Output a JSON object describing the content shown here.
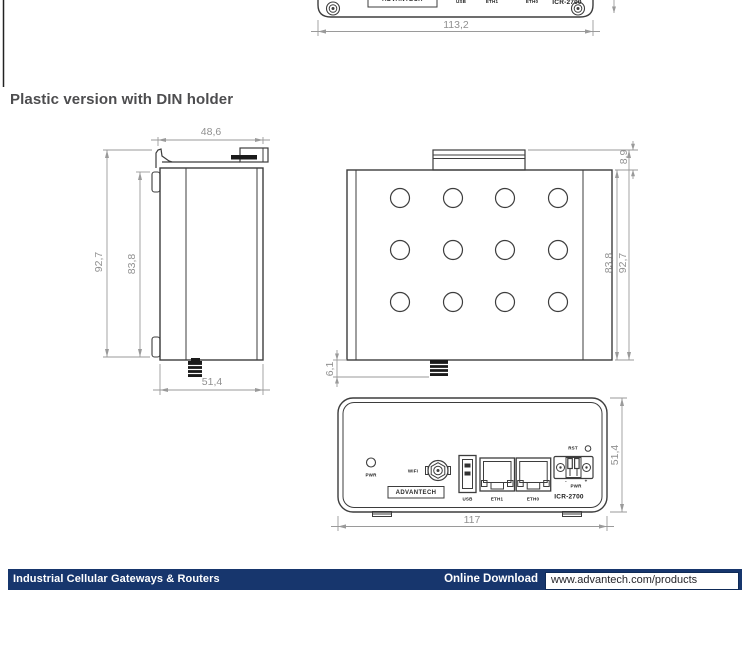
{
  "header": {
    "heading": "Plastic version with DIN holder"
  },
  "top_partial_view": {
    "brand": "ADVANTECH",
    "labels": {
      "usb": "USB",
      "eth1": "ETH1",
      "eth0": "ETH0"
    },
    "model": "ICR-2700",
    "dims": {
      "width": "113,2"
    }
  },
  "side_view": {
    "dims": {
      "top_width": "48,6",
      "bottom_width": "51,4",
      "height_outer": "92,7",
      "height_inner": "83,8"
    }
  },
  "top_view": {
    "dims": {
      "din_offset": "8,9",
      "depth_inner": "83,8",
      "depth_outer": "92,7",
      "antenna_offset": "6,1"
    }
  },
  "front_view": {
    "labels": {
      "led": "PWR",
      "wifi": "WiFi",
      "brand": "ADVANTECH",
      "usb": "USB",
      "eth1": "ETH1",
      "eth0": "ETH0",
      "rst": "RST",
      "pwr": "PWR",
      "minus": "-",
      "plus": "+",
      "model": "ICR-2700"
    },
    "dims": {
      "width": "117",
      "height": "51,4"
    }
  },
  "footer": {
    "category": "Industrial Cellular Gateways & Routers",
    "download_label": "Online Download",
    "url": "www.advantech.com/products"
  }
}
